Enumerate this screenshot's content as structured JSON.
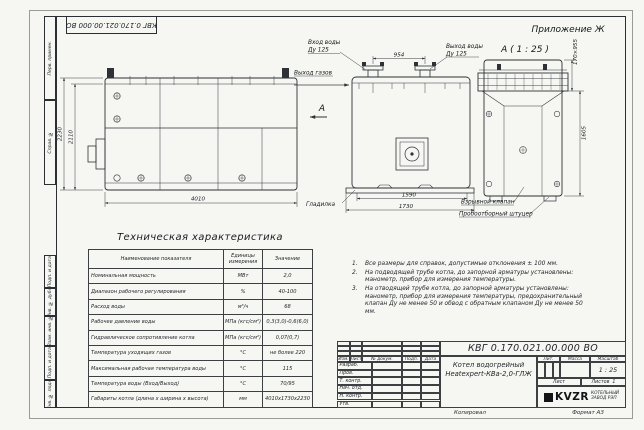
{
  "sheet": {
    "appendix": "Приложение Ж",
    "doc_number_flipped": "КВГ 0.170.021.00.000 ВО",
    "view_a_label": "А ( 1 : 25 )",
    "section_marker": "А",
    "copied": "Копировал",
    "format": "Формат А3"
  },
  "stamps": [
    "Перв. примен.",
    "Справ. №",
    "Подп. и дата",
    "Инв. № дубл.",
    "Взам. инв. №",
    "Подп. и дата",
    "Инв. № подл."
  ],
  "side_view": {
    "dim_height_outer": "2230",
    "dim_height_inner": "2110",
    "dim_length": "4010"
  },
  "front_view": {
    "water_in_l1": "Вход воды",
    "water_in_l2": "Ду 125",
    "water_out_l1": "Выход воды",
    "water_out_l2": "Ду 125",
    "gas_out": "Выход газов",
    "dim_pipes": "954",
    "trowel": "Гладилка",
    "dim_inner": "1590",
    "dim_outer": "1730",
    "valve": "Взрывной клапан",
    "fitting": "Пробоотборный штуцер"
  },
  "a_view": {
    "dim_top": "170×955",
    "dim_height": "1605"
  },
  "table": {
    "title": "Техническая характеристика",
    "headers": [
      "Наименование показателя",
      "Единицы измерения",
      "Значение"
    ],
    "rows": [
      [
        "Номинальная мощность",
        "МВт",
        "2,0"
      ],
      [
        "Диапазон рабочего регулирования",
        "%",
        "40-100"
      ],
      [
        "Расход воды",
        "м³/ч",
        "68"
      ],
      [
        "Рабочее давление воды",
        "МПа (кгс/см²)",
        "0,3(3,0)-0,6(6,0)"
      ],
      [
        "Гидравлическое сопротивление котла",
        "МПа (кгс/см²)",
        "0,07(0,7)"
      ],
      [
        "Температура уходящих газов",
        "°С",
        "не более 220"
      ],
      [
        "Максимальная рабочая температура воды",
        "°С",
        "115"
      ],
      [
        "Температура воды (Вход/Выход)",
        "°С",
        "70/95"
      ],
      [
        "Габариты котла (длина х ширина х высота)",
        "мм",
        "4010х1730х2230"
      ]
    ]
  },
  "notes": [
    {
      "num": "1.",
      "text": "Все размеры для справок, допустимые отклонения ± 100 мм."
    },
    {
      "num": "2.",
      "text": "На подводящей трубе котла, до запорной арматуры установлены: манометр, прибор для измерения температуры."
    },
    {
      "num": "3.",
      "text": "На отводящей трубе котла, до запорной арматуры установлены: манометр, прибор для измерения температуры, предохранительный клапан Ду не менее 50 и обвод с обратным клапаном Ду не менее 50 мм."
    }
  ],
  "title_block": {
    "doc_number": "КВГ 0.170.021.00.000 ВО",
    "name_line1": "Котел водогрейный",
    "name_line2": "Heatexpert-КВа-2,0-ГЛЖ",
    "cols": [
      "Изм.",
      "Лист",
      "№ докум.",
      "Подп.",
      "Дата"
    ],
    "rows": [
      "Разраб.",
      "Пров.",
      "Т. контр.",
      "Нач. отд.",
      "Н. контр.",
      "Утв."
    ],
    "lit": "Лит.",
    "mass": "Масса",
    "scale": "Масштаб",
    "scale_value": "1 : 25",
    "sheet": "Лист",
    "sheets": "Листов",
    "sheets_value": "1",
    "logo": "KVZR",
    "logo_line1": "КОТЕЛЬНЫЙ",
    "logo_line2": "ЗАВОД РЭП"
  }
}
